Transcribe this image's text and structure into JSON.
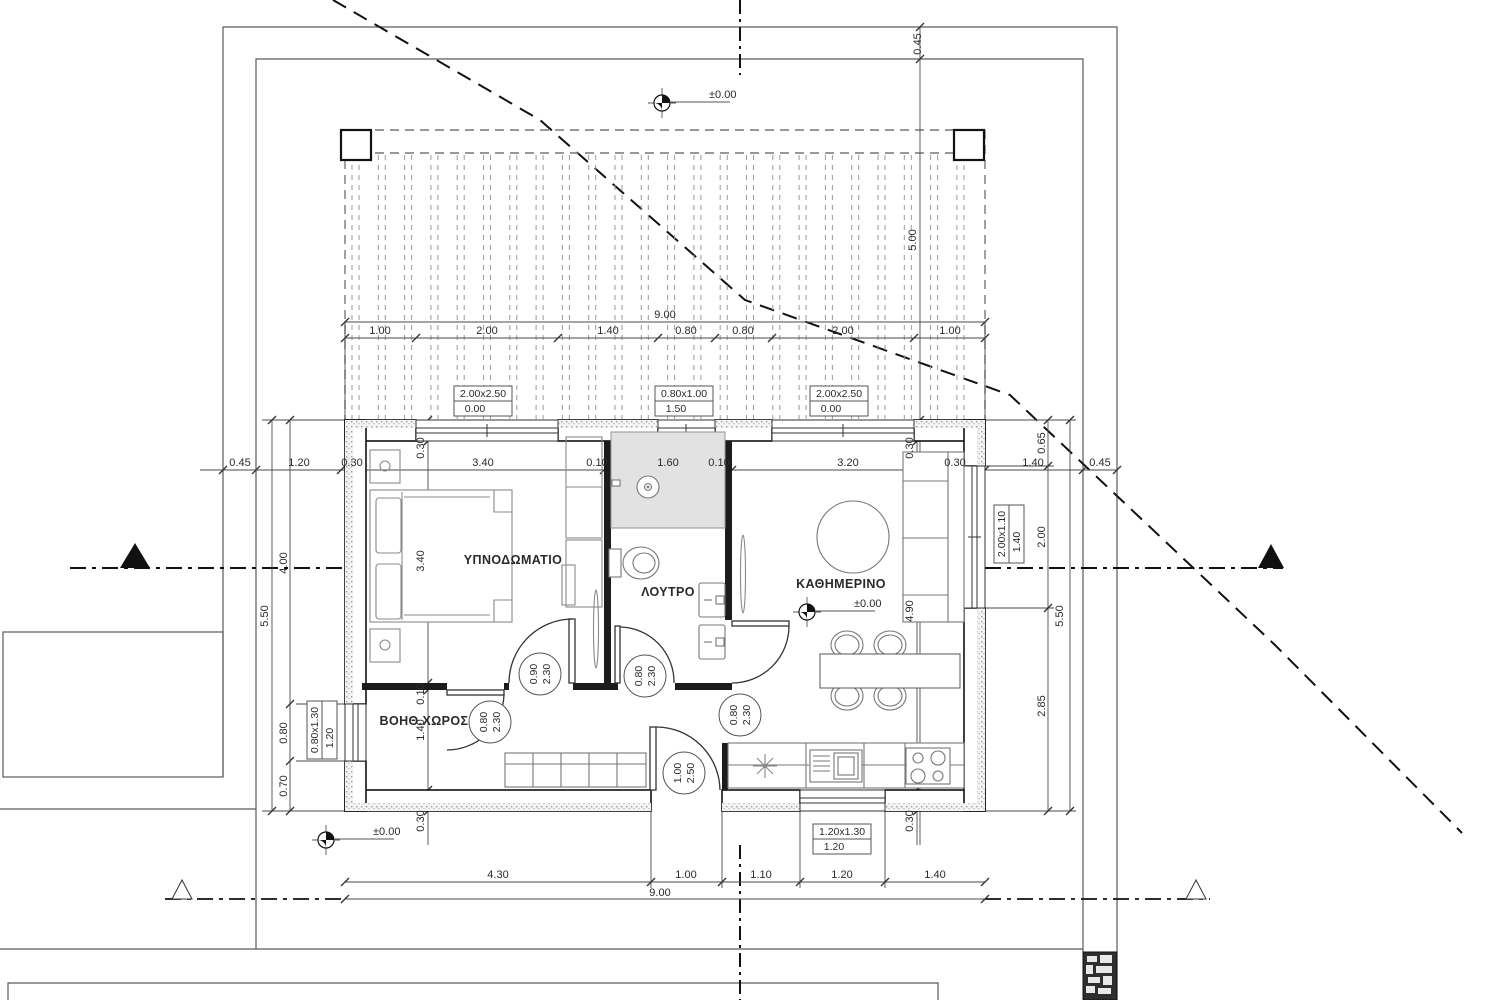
{
  "drawing": {
    "title": "floor-plan",
    "colors": {
      "line": "#1a1a1a",
      "dim": "#4a4a4a",
      "light": "#9a9a9a",
      "furniture": "#8a8a8a",
      "shower_fill": "#e2e2e2",
      "wall_stipple": "#b8b8b8"
    },
    "rooms": [
      {
        "name": "room-bedroom",
        "t": "ΥΠΝΟΔΩΜΑΤΙΟ",
        "x": 513,
        "y": 564
      },
      {
        "name": "room-bathroom",
        "t": "ΛΟΥΤΡΟ",
        "x": 668,
        "y": 596
      },
      {
        "name": "room-living",
        "t": "ΚΑΘΗΜΕΡΙΝΟ",
        "x": 841,
        "y": 588
      },
      {
        "name": "room-auxiliary",
        "t": "ΒΟΗΘ.ΧΩΡΟΣ",
        "x": 424,
        "y": 725
      }
    ],
    "dim_labels": [
      {
        "name": "dim-top-total",
        "t": "9.00",
        "x": 665,
        "y": 318,
        "rot": 0
      },
      {
        "name": "dim-top-1",
        "t": "1.00",
        "x": 380,
        "y": 334,
        "rot": 0
      },
      {
        "name": "dim-top-2",
        "t": "2.00",
        "x": 487,
        "y": 334,
        "rot": 0
      },
      {
        "name": "dim-top-3",
        "t": "1.40",
        "x": 608,
        "y": 334,
        "rot": 0
      },
      {
        "name": "dim-top-4",
        "t": "0.80",
        "x": 686,
        "y": 334,
        "rot": 0
      },
      {
        "name": "dim-top-5",
        "t": "0.80",
        "x": 743,
        "y": 334,
        "rot": 0
      },
      {
        "name": "dim-top-6",
        "t": "2.00",
        "x": 843,
        "y": 334,
        "rot": 0
      },
      {
        "name": "dim-top-7",
        "t": "1.00",
        "x": 950,
        "y": 334,
        "rot": 0
      },
      {
        "name": "dim-main-1",
        "t": "0.45",
        "x": 240,
        "y": 466,
        "rot": 0
      },
      {
        "name": "dim-main-2",
        "t": "1.20",
        "x": 299,
        "y": 466,
        "rot": 0
      },
      {
        "name": "dim-main-3",
        "t": "0.30",
        "x": 352,
        "y": 466,
        "rot": 0
      },
      {
        "name": "dim-main-4",
        "t": "3.40",
        "x": 483,
        "y": 466,
        "rot": 0
      },
      {
        "name": "dim-main-5",
        "t": "0.10",
        "x": 597,
        "y": 466,
        "rot": 0
      },
      {
        "name": "dim-main-6",
        "t": "1.60",
        "x": 668,
        "y": 466,
        "rot": 0
      },
      {
        "name": "dim-main-7",
        "t": "0.10",
        "x": 719,
        "y": 466,
        "rot": 0
      },
      {
        "name": "dim-main-8",
        "t": "3.20",
        "x": 848,
        "y": 466,
        "rot": 0
      },
      {
        "name": "dim-main-9",
        "t": "0.30",
        "x": 955,
        "y": 466,
        "rot": 0
      },
      {
        "name": "dim-main-10",
        "t": "1.40",
        "x": 1033,
        "y": 466,
        "rot": 0
      },
      {
        "name": "dim-main-11",
        "t": "0.45",
        "x": 1100,
        "y": 466,
        "rot": 0
      },
      {
        "name": "dim-left-total",
        "t": "5.50",
        "x": 268,
        "y": 616,
        "rot": 1
      },
      {
        "name": "dim-left-1",
        "t": "4.00",
        "x": 287,
        "y": 563,
        "rot": 1
      },
      {
        "name": "dim-left-2",
        "t": "0.80",
        "x": 287,
        "y": 733,
        "rot": 1
      },
      {
        "name": "dim-left-3",
        "t": "0.70",
        "x": 287,
        "y": 786,
        "rot": 1
      },
      {
        "name": "dim-right-1",
        "t": "0.65",
        "x": 1045,
        "y": 443,
        "rot": 1
      },
      {
        "name": "dim-right-2",
        "t": "2.00",
        "x": 1045,
        "y": 537,
        "rot": 1
      },
      {
        "name": "dim-right-3",
        "t": "2.85",
        "x": 1045,
        "y": 706,
        "rot": 1
      },
      {
        "name": "dim-right-total",
        "t": "5.50",
        "x": 1063,
        "y": 616,
        "rot": 1
      },
      {
        "name": "dim-setback",
        "t": "5.00",
        "x": 916,
        "y": 240,
        "rot": 1
      },
      {
        "name": "dim-boundary",
        "t": "0.45",
        "x": 921,
        "y": 44,
        "rot": 1
      },
      {
        "name": "dim-intL-1",
        "t": "0.30",
        "x": 424,
        "y": 448,
        "rot": 1
      },
      {
        "name": "dim-intL-2",
        "t": "3.40",
        "x": 424,
        "y": 561,
        "rot": 1
      },
      {
        "name": "dim-intL-3",
        "t": "0.10",
        "x": 424,
        "y": 694,
        "rot": 1
      },
      {
        "name": "dim-intL-4",
        "t": "1.40",
        "x": 424,
        "y": 730,
        "rot": 1
      },
      {
        "name": "dim-intL-5",
        "t": "0.30",
        "x": 424,
        "y": 821,
        "rot": 1
      },
      {
        "name": "dim-intR-1",
        "t": "0.30",
        "x": 913,
        "y": 448,
        "rot": 1
      },
      {
        "name": "dim-intR-2",
        "t": "4.90",
        "x": 913,
        "y": 611,
        "rot": 1
      },
      {
        "name": "dim-intR-3",
        "t": "0.30",
        "x": 913,
        "y": 821,
        "rot": 1
      },
      {
        "name": "dim-bot-1",
        "t": "4.30",
        "x": 498,
        "y": 878,
        "rot": 0
      },
      {
        "name": "dim-bot-2",
        "t": "1.00",
        "x": 686,
        "y": 878,
        "rot": 0
      },
      {
        "name": "dim-bot-3",
        "t": "1.10",
        "x": 761,
        "y": 878,
        "rot": 0
      },
      {
        "name": "dim-bot-4",
        "t": "1.20",
        "x": 842,
        "y": 878,
        "rot": 0
      },
      {
        "name": "dim-bot-5",
        "t": "1.40",
        "x": 935,
        "y": 878,
        "rot": 0
      },
      {
        "name": "dim-bot-total",
        "t": "9.00",
        "x": 660,
        "y": 896,
        "rot": 0
      }
    ],
    "window_tags": [
      {
        "name": "window-tag-top-1",
        "lines": [
          "2.00x2.50",
          "0.00"
        ],
        "cx": 483,
        "cy": 401,
        "rot": 0
      },
      {
        "name": "window-tag-top-2",
        "lines": [
          "0.80x1.00",
          "1.50"
        ],
        "cx": 684,
        "cy": 401,
        "rot": 0
      },
      {
        "name": "window-tag-top-3",
        "lines": [
          "2.00x2.50",
          "0.00"
        ],
        "cx": 839,
        "cy": 401,
        "rot": 0
      },
      {
        "name": "window-tag-right",
        "lines": [
          "2.00x1.10",
          "1.40"
        ],
        "cx": 1009,
        "cy": 534,
        "rot": 1
      },
      {
        "name": "window-tag-left",
        "lines": [
          "0.80x1.30",
          "1.20"
        ],
        "cx": 322,
        "cy": 730,
        "rot": 1
      },
      {
        "name": "window-tag-bottom",
        "lines": [
          "1.20x1.30",
          "1.20"
        ],
        "cx": 842,
        "cy": 839,
        "rot": 0
      }
    ],
    "door_tags": [
      {
        "name": "door-tag-bedroom",
        "lines": [
          "0.90",
          "2.30"
        ],
        "cx": 540,
        "cy": 674
      },
      {
        "name": "door-tag-bathroom",
        "lines": [
          "0.80",
          "2.30"
        ],
        "cx": 645,
        "cy": 676
      },
      {
        "name": "door-tag-auxiliary",
        "lines": [
          "0.80",
          "2.30"
        ],
        "cx": 490,
        "cy": 722
      },
      {
        "name": "door-tag-living",
        "lines": [
          "0.80",
          "2.30"
        ],
        "cx": 740,
        "cy": 715
      },
      {
        "name": "door-tag-entrance",
        "lines": [
          "1.00",
          "2.50"
        ],
        "cx": 684,
        "cy": 773
      }
    ],
    "level_markers": [
      {
        "name": "level-marker-site-top",
        "t": "±0.00",
        "sx": 662,
        "sy": 103,
        "lx": 697,
        "ly": 98
      },
      {
        "name": "level-marker-living",
        "t": "±0.00",
        "sx": 807,
        "sy": 612,
        "lx": 842,
        "ly": 607
      },
      {
        "name": "level-marker-site-bottom",
        "t": "±0.00",
        "sx": 326,
        "sy": 840,
        "lx": 361,
        "ly": 835
      }
    ]
  }
}
